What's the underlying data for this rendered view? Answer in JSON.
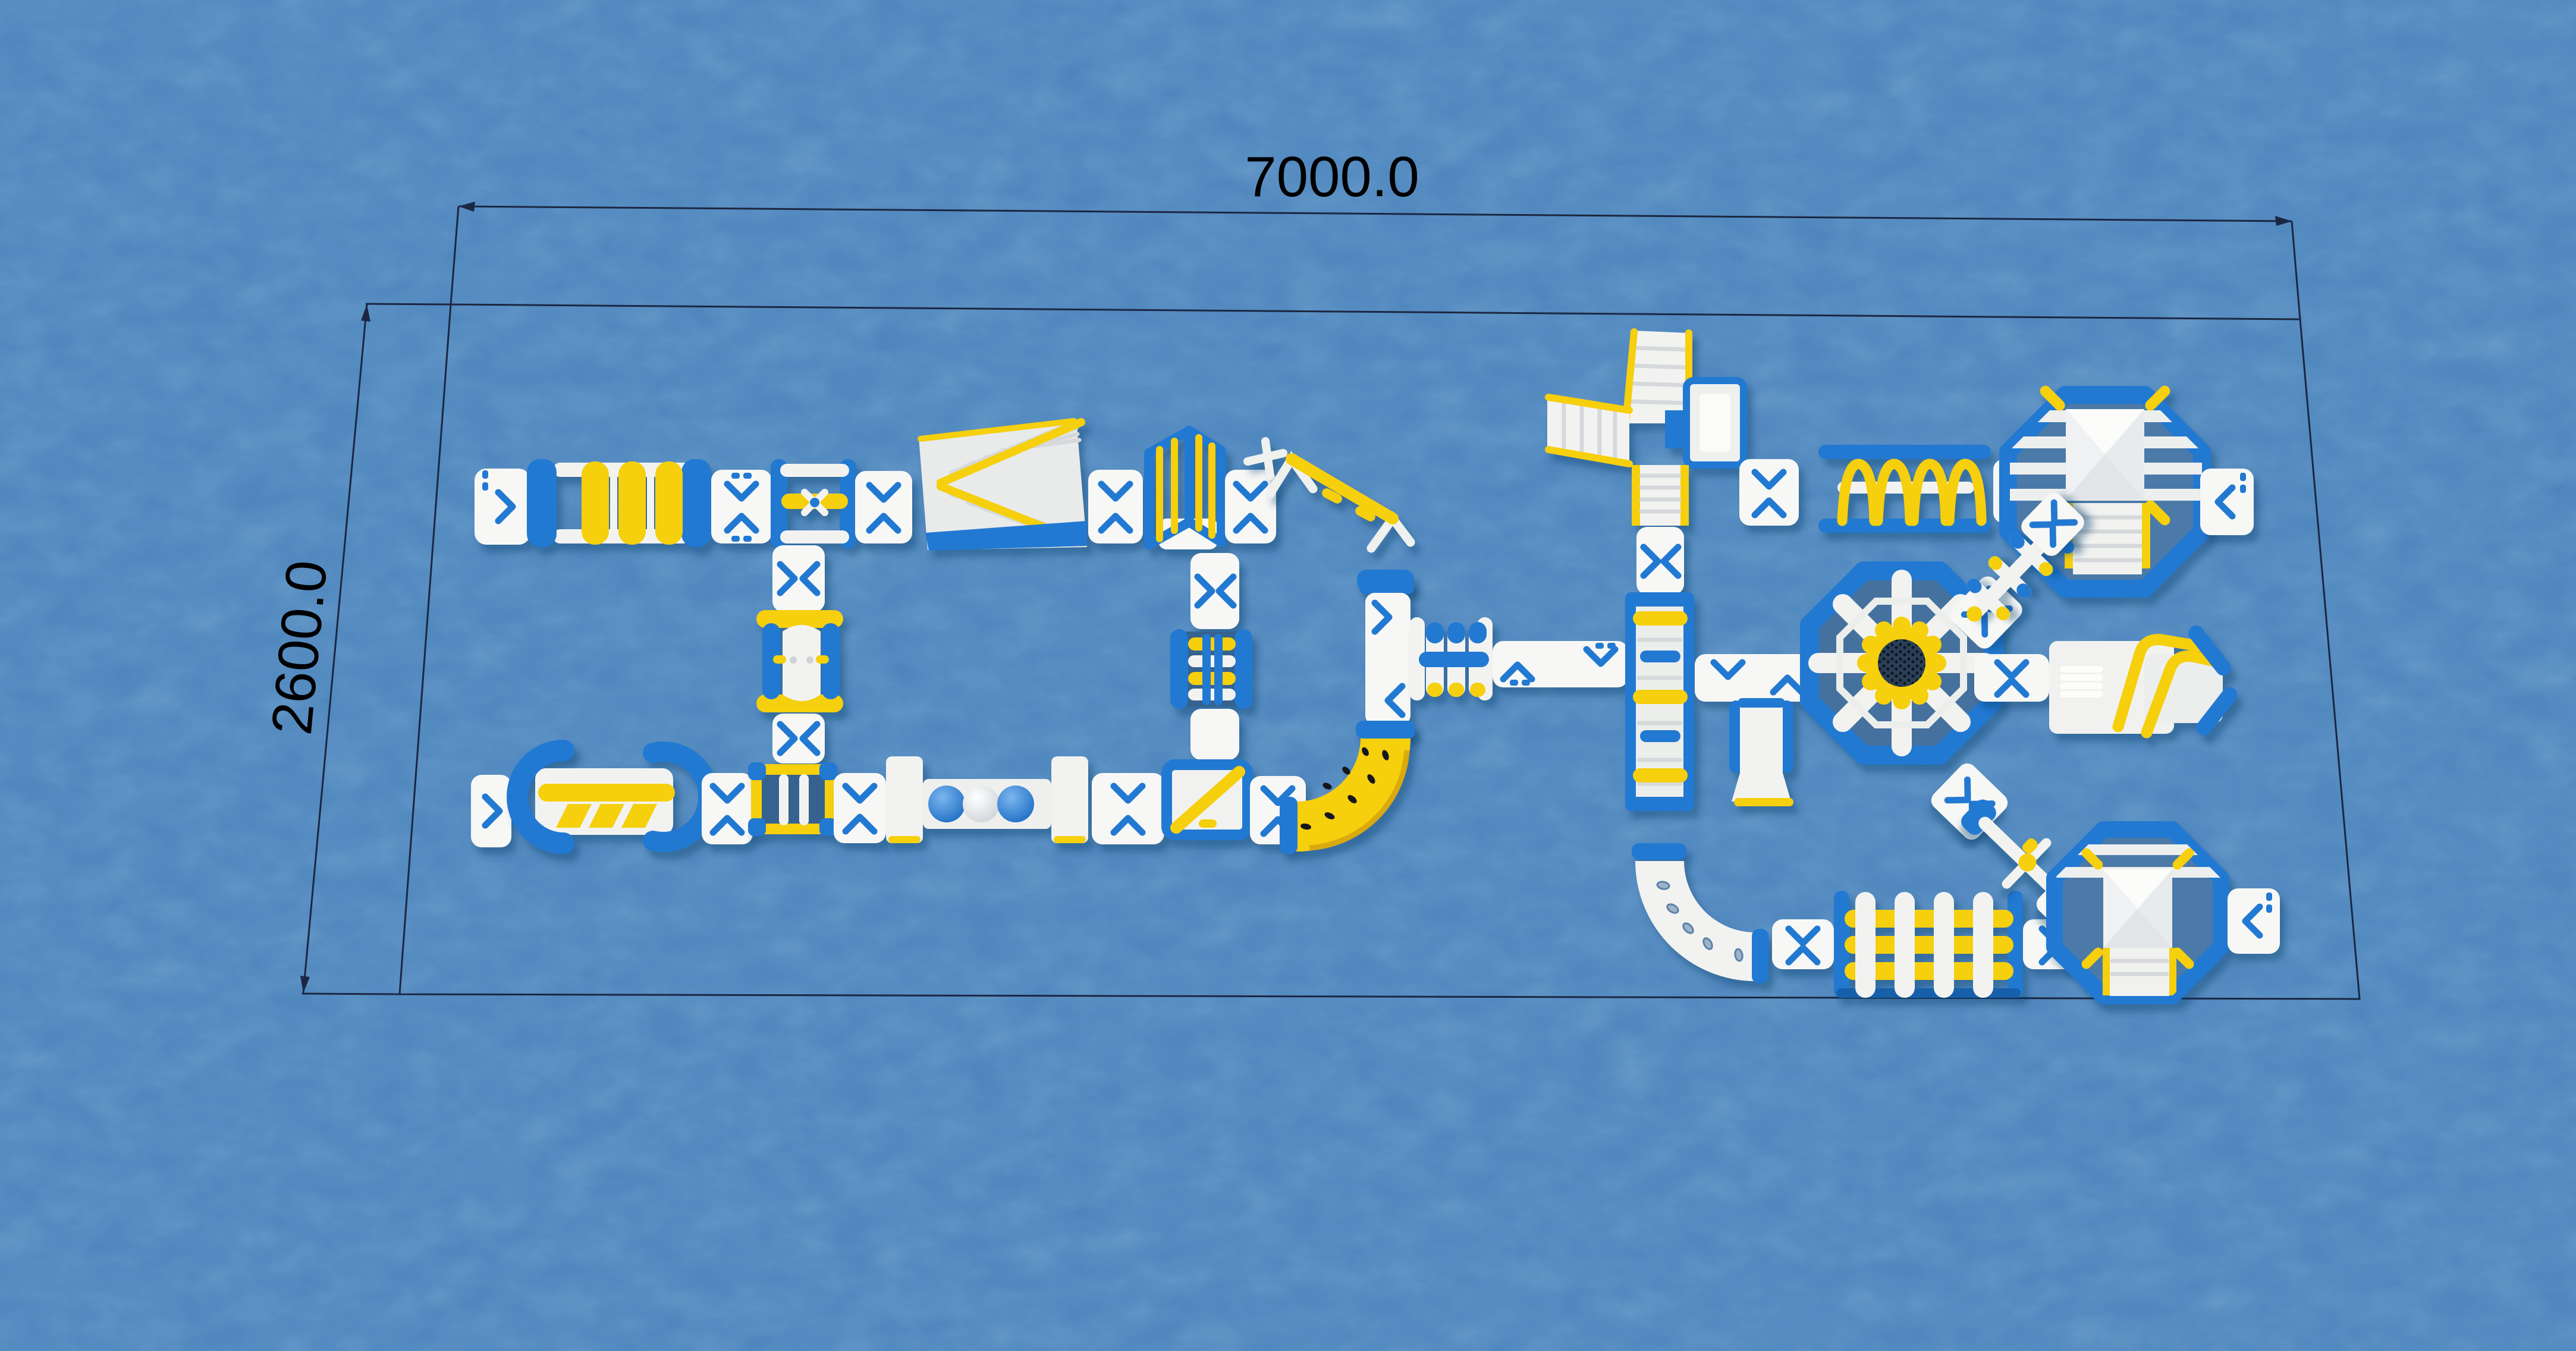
{
  "scene": {
    "subject": "Top-view 3D render of an inflatable floating water park obstacle course on blue water",
    "view": "plan view with CAD dimension lines"
  },
  "dimensions": {
    "width_label": "7000.0",
    "height_label": "2600.0"
  },
  "colors": {
    "water": "#4e86bd",
    "float_white": "#f2f3f1",
    "pad_white": "#f7f8f6",
    "accent_blue": "#2479d2",
    "accent_yellow": "#f6cf0b",
    "yellow_shade": "#d9a90c",
    "blue_shade": "#1460ab",
    "mesh_navy": "#2c3f57",
    "line": "#1b2742",
    "text": "#000000"
  },
  "modules": [
    {
      "id": "start-platform",
      "label": "Start platform"
    },
    {
      "id": "roller-bridge",
      "label": "Yellow roller bridge"
    },
    {
      "id": "hurdle-gate",
      "label": "Hurdle gate"
    },
    {
      "id": "summit-climb",
      "label": "Summit wedge climb"
    },
    {
      "id": "ladder-tower",
      "label": "Ladder tower gate"
    },
    {
      "id": "swing-beam",
      "label": "Swing beam"
    },
    {
      "id": "teeter-lane",
      "label": "Teeter lane"
    },
    {
      "id": "rung-frame",
      "label": "Rung frame"
    },
    {
      "id": "balance-bridge",
      "label": "Balance beam bridge"
    },
    {
      "id": "ball-walk",
      "label": "Ball walk"
    },
    {
      "id": "beam-junction",
      "label": "Diagonal beam junction"
    },
    {
      "id": "corner-slide-yellow",
      "label": "Yellow corner climb"
    },
    {
      "id": "climb-frame",
      "label": "Climb frame"
    },
    {
      "id": "overunder-gates",
      "label": "Over-under gates"
    },
    {
      "id": "slide-tower",
      "label": "Triple slide tower"
    },
    {
      "id": "stair-climb",
      "label": "Stair climb"
    },
    {
      "id": "flip-lane",
      "label": "Flip obstacle lane"
    },
    {
      "id": "corner-slide-white",
      "label": "White corner lane"
    },
    {
      "id": "roller-tunnel",
      "label": "Roller tunnel"
    },
    {
      "id": "octagon-trampoline",
      "label": "Octagon trampoline hub"
    },
    {
      "id": "mini-slide",
      "label": "Mini slide"
    },
    {
      "id": "arch-hurdles",
      "label": "Arch hurdles"
    },
    {
      "id": "jump-cube-north",
      "label": "Jump cube platform north"
    },
    {
      "id": "jump-cube-south",
      "label": "Jump cube platform south"
    },
    {
      "id": "diagonal-ladder",
      "label": "Diagonal rung ladder"
    },
    {
      "id": "diagonal-seesaw",
      "label": "Diagonal seesaw"
    },
    {
      "id": "catapult-blob",
      "label": "Launch blob"
    },
    {
      "id": "walk-pad",
      "label": "Connector walk pad"
    }
  ]
}
